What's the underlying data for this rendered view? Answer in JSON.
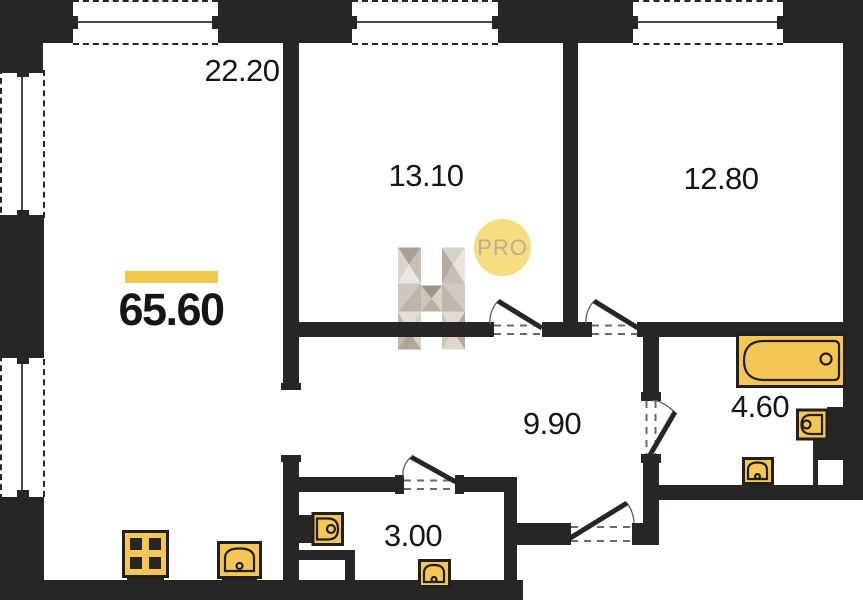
{
  "plan": {
    "total_area": "65.60",
    "rooms": {
      "living_kitchen": "22.20",
      "bedroom_1": "13.10",
      "bedroom_2": "12.80",
      "hallway": "9.90",
      "bathroom": "4.60",
      "wc": "3.00"
    },
    "fixtures": [
      "stove-icon",
      "kitchen-sink-icon",
      "wc-toilet-icon",
      "wc-washbasin-icon",
      "bathtub-icon",
      "bathroom-toilet-icon",
      "bathroom-washbasin-icon"
    ]
  },
  "watermark": {
    "logo_letter": "H",
    "badge_label": "PRO"
  },
  "colors": {
    "background": "#FFFFFF",
    "wall": "#282624",
    "fixture": "#F3C656",
    "fixture_stroke": "#22201D",
    "glass": "#4A4A4A",
    "accent_bar": "#F2C84B",
    "badge_bg": "#F8DC80",
    "badge_text": "#B9B097",
    "label_text": "#161616"
  }
}
